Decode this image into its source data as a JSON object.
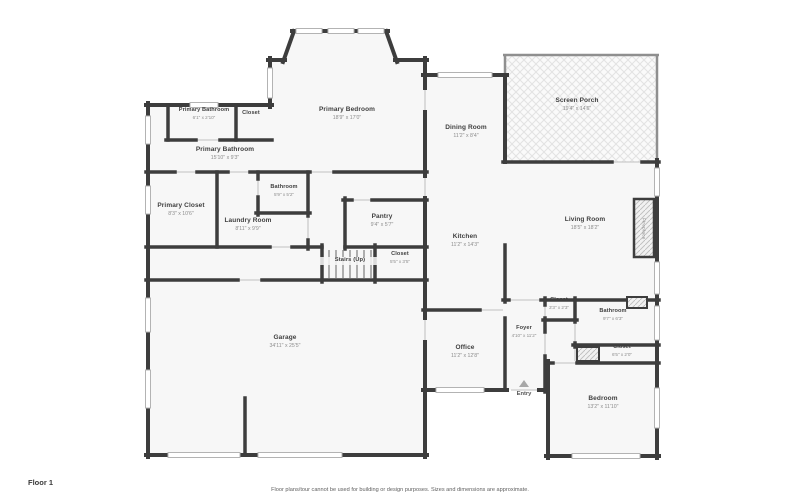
{
  "page": {
    "floor_label": "Floor 1",
    "disclaimer": "Floor plans/tour cannot be used for building or design purposes. Sizes and dimensions are approximate."
  },
  "rooms": {
    "primary_bathroom_small": {
      "name": "Primary Bathroom",
      "dims": "6'1\" x 2'10\""
    },
    "closet_top": {
      "name": "Closet",
      "dims": ""
    },
    "primary_bedroom": {
      "name": "Primary Bedroom",
      "dims": "18'9\" x 17'0\""
    },
    "primary_bathroom_main": {
      "name": "Primary Bathroom",
      "dims": "15'10\" x 9'3\""
    },
    "dining_room": {
      "name": "Dining Room",
      "dims": "11'2\" x 8'4\""
    },
    "screen_porch": {
      "name": "Screen Porch",
      "dims": "19'4\" x 14'6\""
    },
    "primary_closet": {
      "name": "Primary Closet",
      "dims": "8'3\" x 10'6\""
    },
    "laundry_room": {
      "name": "Laundry Room",
      "dims": "8'11\" x 9'9\""
    },
    "bathroom_small": {
      "name": "Bathroom",
      "dims": "5'9\" x 5'2\""
    },
    "pantry": {
      "name": "Pantry",
      "dims": "9'4\" x 5'7\""
    },
    "kitchen": {
      "name": "Kitchen",
      "dims": "11'2\" x 14'3\""
    },
    "living_room": {
      "name": "Living Room",
      "dims": "18'5\" x 18'2\""
    },
    "fireplace": {
      "name": "Fireplace",
      "dims": ""
    },
    "stairs": {
      "name": "Stairs (Up)",
      "dims": ""
    },
    "closet_stairs": {
      "name": "Closet",
      "dims": "5'5\" x 3'5\""
    },
    "garage": {
      "name": "Garage",
      "dims": "34'11\" x 25'5\""
    },
    "office": {
      "name": "Office",
      "dims": "11'2\" x 12'8\""
    },
    "foyer": {
      "name": "Foyer",
      "dims": "4'10\" x 11'2\""
    },
    "entry": {
      "name": "Entry",
      "dims": ""
    },
    "closet_foyer": {
      "name": "Closet",
      "dims": "3'3\" x 2'3\""
    },
    "bathroom_br": {
      "name": "Bathroom",
      "dims": "9'7\" x 6'3\""
    },
    "closet_br": {
      "name": "Closet",
      "dims": "6'5\" x 2'0\""
    },
    "bedroom": {
      "name": "Bedroom",
      "dims": "13'2\" x 11'10\""
    }
  }
}
